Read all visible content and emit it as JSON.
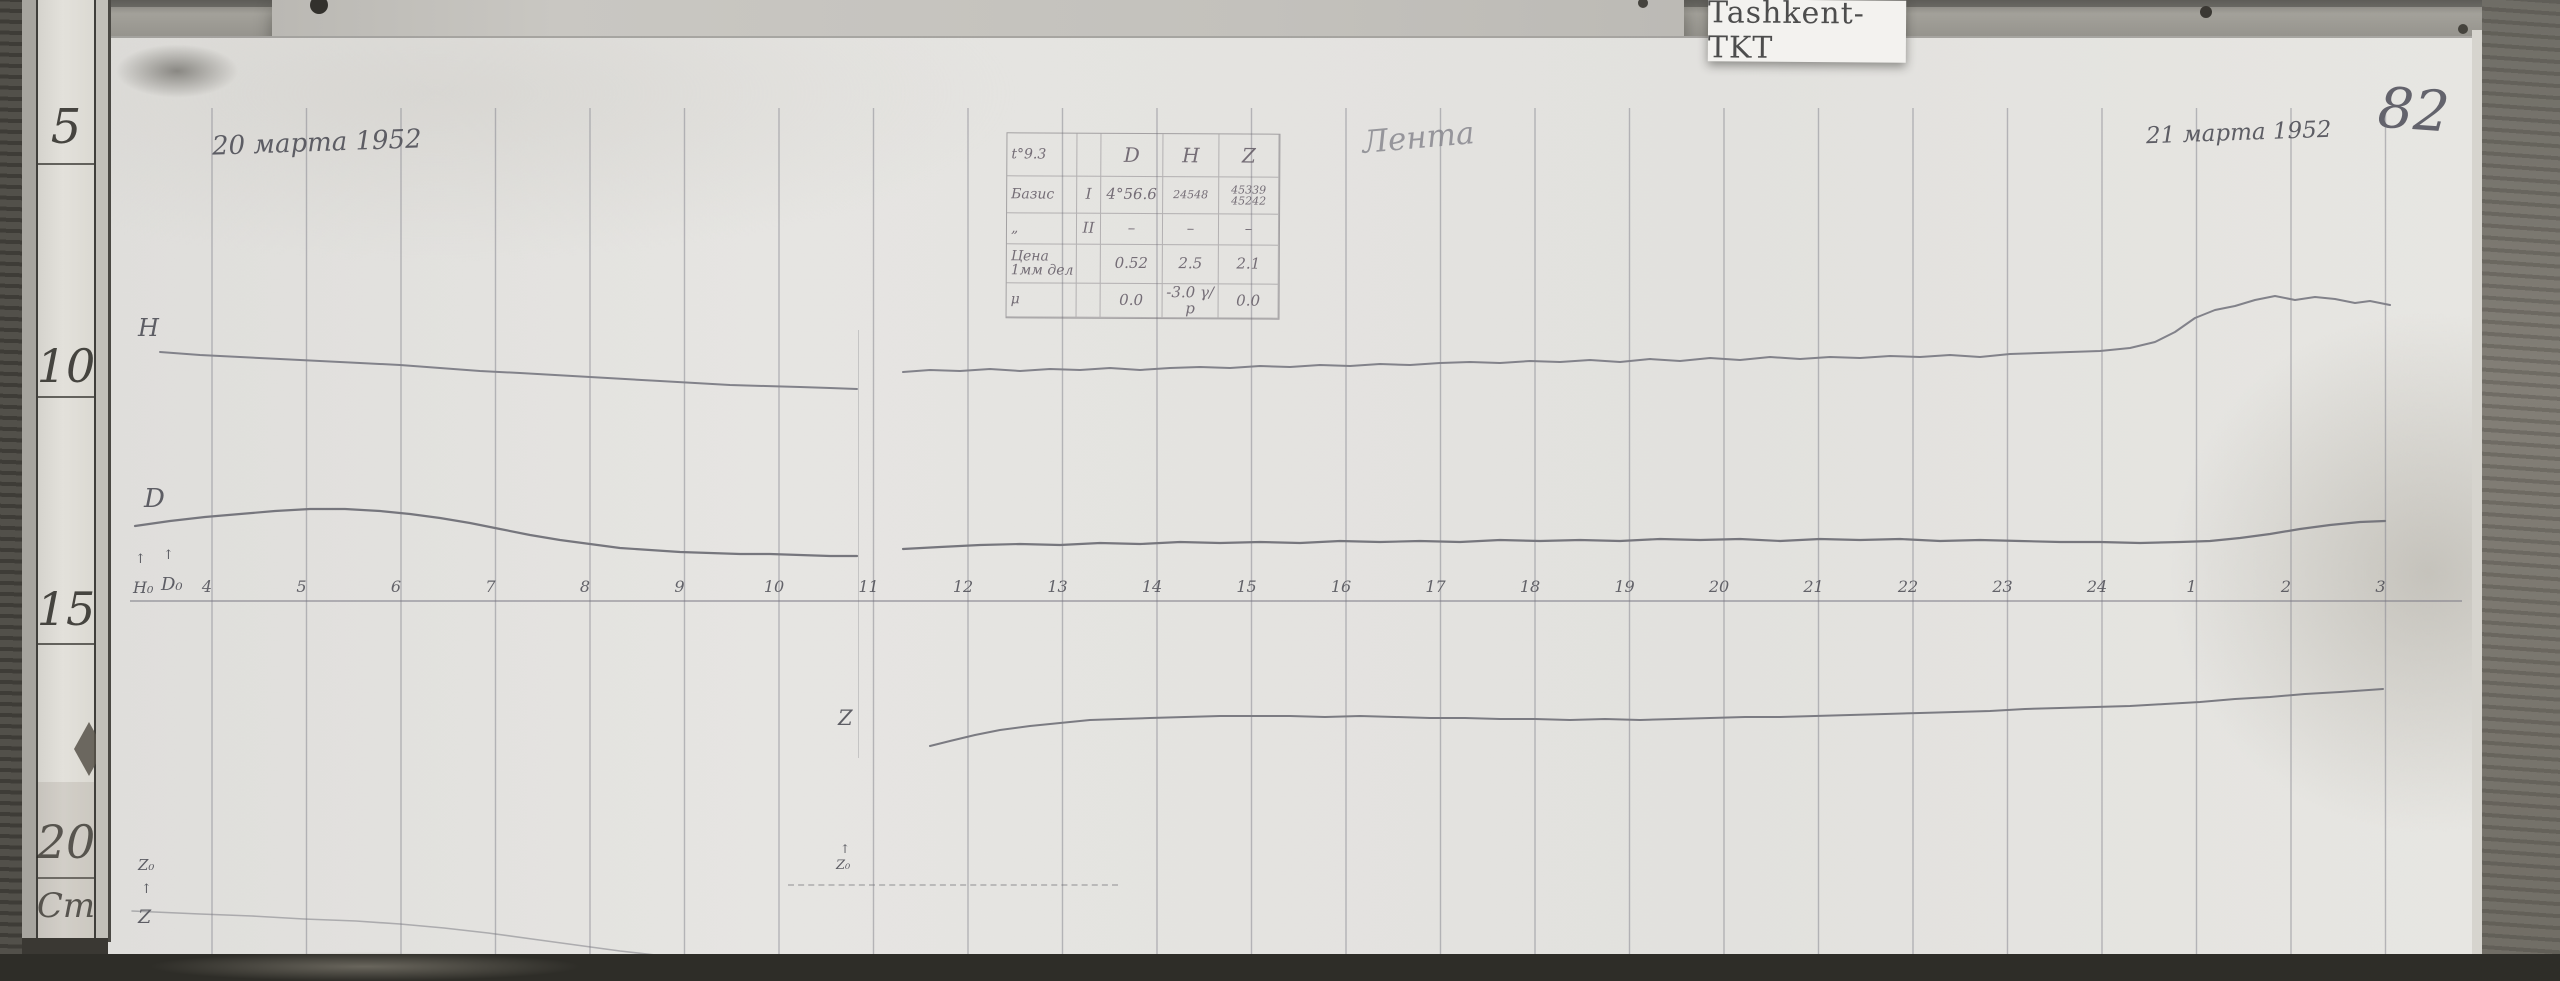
{
  "header": {
    "station_label": "Tashkent-TKT",
    "page_number": "82",
    "date_left": "20 марта 1952",
    "date_right": "21 марта 1952",
    "script_note": "Лента"
  },
  "ruler": {
    "unit_label": "Cm",
    "marks": [
      {
        "label": "5",
        "y": 127,
        "size": 48
      },
      {
        "label": "10",
        "y": 366,
        "size": 46
      },
      {
        "label": "15",
        "y": 609,
        "size": 46
      },
      {
        "label": "20",
        "y": 842,
        "size": 46
      },
      {
        "label": "Cm",
        "y": 906,
        "size": 34
      }
    ],
    "dividers_y": [
      163,
      396,
      643,
      877
    ]
  },
  "curve_labels": {
    "h": "Н",
    "d": "D",
    "z": "Z",
    "h0": "Н₀",
    "d0": "D₀",
    "z0_left": "Z₀",
    "z_baseline": "Z",
    "z0_mid": "Z₀",
    "arrow": "↑"
  },
  "table": {
    "rows": [
      [
        "t°9.3",
        "",
        "D",
        "Н",
        "Z"
      ],
      [
        "Базис",
        "I",
        "4°56.6",
        "24548",
        "45339 45242"
      ],
      [
        "„",
        "II",
        "–",
        "–",
        "–"
      ],
      [
        "Цена 1мм дел",
        "",
        "0.52",
        "2.5",
        "2.1"
      ],
      [
        "μ",
        "",
        "0.0",
        "-3.0 γ/р",
        "0.0"
      ]
    ]
  },
  "chart_data": {
    "type": "line",
    "title": "Magnetogram traces H, D, Z — Tashkent (TKT), 20–21 March 1952",
    "x_unit": "hour",
    "x_ticks": [
      "4",
      "5",
      "6",
      "7",
      "8",
      "9",
      "10",
      "11",
      "12",
      "13",
      "14",
      "15",
      "16",
      "17",
      "18",
      "19",
      "20",
      "21",
      "22",
      "23",
      "24",
      "1",
      "2",
      "3"
    ],
    "grid": {
      "x_start": 212,
      "x_step": 94.5,
      "lines": 24,
      "y_top": 108,
      "y_bottom": 954,
      "axis_y": 601,
      "axis_x1": 130,
      "axis_x2": 2462,
      "line_color": "rgba(130,129,140,.5)",
      "axis_color": "rgba(120,119,130,.65)"
    },
    "series": [
      {
        "name": "H",
        "color": "#82828a",
        "width": 2,
        "segments": [
          [
            [
              160,
              352
            ],
            [
              200,
              355
            ],
            [
              240,
              357
            ],
            [
              280,
              359
            ],
            [
              320,
              361
            ],
            [
              360,
              363
            ],
            [
              400,
              365
            ],
            [
              440,
              368
            ],
            [
              480,
              371
            ],
            [
              520,
              373
            ],
            [
              555,
              375
            ],
            [
              590,
              377
            ],
            [
              625,
              379
            ],
            [
              660,
              381
            ],
            [
              695,
              383
            ],
            [
              730,
              385
            ],
            [
              765,
              386
            ],
            [
              800,
              387
            ],
            [
              830,
              388
            ],
            [
              857,
              389
            ]
          ],
          [
            [
              903,
              372
            ],
            [
              930,
              370
            ],
            [
              960,
              371
            ],
            [
              990,
              369
            ],
            [
              1020,
              371
            ],
            [
              1050,
              369
            ],
            [
              1080,
              370
            ],
            [
              1110,
              368
            ],
            [
              1140,
              370
            ],
            [
              1170,
              368
            ],
            [
              1200,
              367
            ],
            [
              1230,
              368
            ],
            [
              1260,
              366
            ],
            [
              1290,
              367
            ],
            [
              1320,
              365
            ],
            [
              1350,
              366
            ],
            [
              1380,
              364
            ],
            [
              1410,
              365
            ],
            [
              1440,
              363
            ],
            [
              1470,
              362
            ],
            [
              1500,
              363
            ],
            [
              1530,
              361
            ],
            [
              1560,
              362
            ],
            [
              1590,
              360
            ],
            [
              1620,
              362
            ],
            [
              1650,
              359
            ],
            [
              1680,
              361
            ],
            [
              1710,
              358
            ],
            [
              1740,
              360
            ],
            [
              1770,
              357
            ],
            [
              1800,
              359
            ],
            [
              1830,
              357
            ],
            [
              1860,
              358
            ],
            [
              1890,
              356
            ],
            [
              1920,
              357
            ],
            [
              1950,
              355
            ],
            [
              1980,
              357
            ],
            [
              2010,
              354
            ],
            [
              2040,
              353
            ],
            [
              2070,
              352
            ],
            [
              2100,
              351
            ],
            [
              2130,
              348
            ],
            [
              2155,
              342
            ],
            [
              2175,
              332
            ],
            [
              2195,
              318
            ],
            [
              2215,
              310
            ],
            [
              2235,
              306
            ],
            [
              2255,
              300
            ],
            [
              2275,
              296
            ],
            [
              2295,
              300
            ],
            [
              2315,
              297
            ],
            [
              2335,
              299
            ],
            [
              2355,
              303
            ],
            [
              2370,
              301
            ],
            [
              2390,
              305
            ]
          ]
        ]
      },
      {
        "name": "D",
        "color": "#76767d",
        "width": 2.2,
        "segments": [
          [
            [
              135,
              526
            ],
            [
              170,
              521
            ],
            [
              205,
              517
            ],
            [
              240,
              514
            ],
            [
              275,
              511
            ],
            [
              310,
              509
            ],
            [
              345,
              509
            ],
            [
              380,
              511
            ],
            [
              410,
              514
            ],
            [
              440,
              518
            ],
            [
              470,
              523
            ],
            [
              500,
              529
            ],
            [
              530,
              535
            ],
            [
              560,
              540
            ],
            [
              590,
              544
            ],
            [
              620,
              548
            ],
            [
              650,
              550
            ],
            [
              680,
              552
            ],
            [
              710,
              553
            ],
            [
              740,
              554
            ],
            [
              770,
              554
            ],
            [
              800,
              555
            ],
            [
              830,
              556
            ],
            [
              857,
              556
            ]
          ],
          [
            [
              903,
              549
            ],
            [
              940,
              547
            ],
            [
              980,
              545
            ],
            [
              1020,
              544
            ],
            [
              1060,
              545
            ],
            [
              1100,
              543
            ],
            [
              1140,
              544
            ],
            [
              1180,
              542
            ],
            [
              1220,
              543
            ],
            [
              1260,
              542
            ],
            [
              1300,
              543
            ],
            [
              1340,
              541
            ],
            [
              1380,
              542
            ],
            [
              1420,
              541
            ],
            [
              1460,
              542
            ],
            [
              1500,
              540
            ],
            [
              1540,
              541
            ],
            [
              1580,
              540
            ],
            [
              1620,
              541
            ],
            [
              1660,
              539
            ],
            [
              1700,
              540
            ],
            [
              1740,
              539
            ],
            [
              1780,
              541
            ],
            [
              1820,
              539
            ],
            [
              1860,
              540
            ],
            [
              1900,
              539
            ],
            [
              1940,
              541
            ],
            [
              1980,
              540
            ],
            [
              2020,
              541
            ],
            [
              2060,
              542
            ],
            [
              2100,
              542
            ],
            [
              2140,
              543
            ],
            [
              2180,
              542
            ],
            [
              2210,
              541
            ],
            [
              2240,
              538
            ],
            [
              2270,
              534
            ],
            [
              2300,
              529
            ],
            [
              2330,
              525
            ],
            [
              2360,
              522
            ],
            [
              2385,
              521
            ]
          ]
        ]
      },
      {
        "name": "Z",
        "color": "#7b7b82",
        "width": 2,
        "segments": [
          [
            [
              930,
              746
            ],
            [
              950,
              741
            ],
            [
              975,
              735
            ],
            [
              1000,
              730
            ],
            [
              1030,
              726
            ],
            [
              1060,
              723
            ],
            [
              1090,
              720
            ],
            [
              1120,
              719
            ],
            [
              1150,
              718
            ],
            [
              1185,
              717
            ],
            [
              1220,
              716
            ],
            [
              1255,
              716
            ],
            [
              1290,
              716
            ],
            [
              1325,
              717
            ],
            [
              1360,
              716
            ],
            [
              1395,
              717
            ],
            [
              1430,
              718
            ],
            [
              1465,
              718
            ],
            [
              1500,
              719
            ],
            [
              1535,
              719
            ],
            [
              1570,
              720
            ],
            [
              1605,
              719
            ],
            [
              1640,
              720
            ],
            [
              1675,
              719
            ],
            [
              1710,
              718
            ],
            [
              1745,
              717
            ],
            [
              1780,
              717
            ],
            [
              1815,
              716
            ],
            [
              1850,
              715
            ],
            [
              1885,
              714
            ],
            [
              1920,
              713
            ],
            [
              1955,
              712
            ],
            [
              1990,
              711
            ],
            [
              2025,
              709
            ],
            [
              2060,
              708
            ],
            [
              2095,
              707
            ],
            [
              2130,
              706
            ],
            [
              2165,
              704
            ],
            [
              2200,
              702
            ],
            [
              2235,
              699
            ],
            [
              2270,
              697
            ],
            [
              2305,
              694
            ],
            [
              2340,
              692
            ],
            [
              2383,
              689
            ]
          ]
        ]
      },
      {
        "name": "Z-baseline",
        "color": "rgba(118,118,126,.5)",
        "width": 1.6,
        "segments": [
          [
            [
              132,
              911
            ],
            [
              200,
              914
            ],
            [
              252,
              916
            ],
            [
              304,
              919
            ],
            [
              356,
              921
            ],
            [
              400,
              924
            ],
            [
              444,
              928
            ],
            [
              488,
              933
            ],
            [
              532,
              939
            ],
            [
              576,
              945
            ],
            [
              620,
              951
            ],
            [
              664,
              956
            ],
            [
              708,
              960
            ],
            [
              740,
              962
            ],
            [
              772,
              964
            ]
          ]
        ]
      }
    ]
  }
}
